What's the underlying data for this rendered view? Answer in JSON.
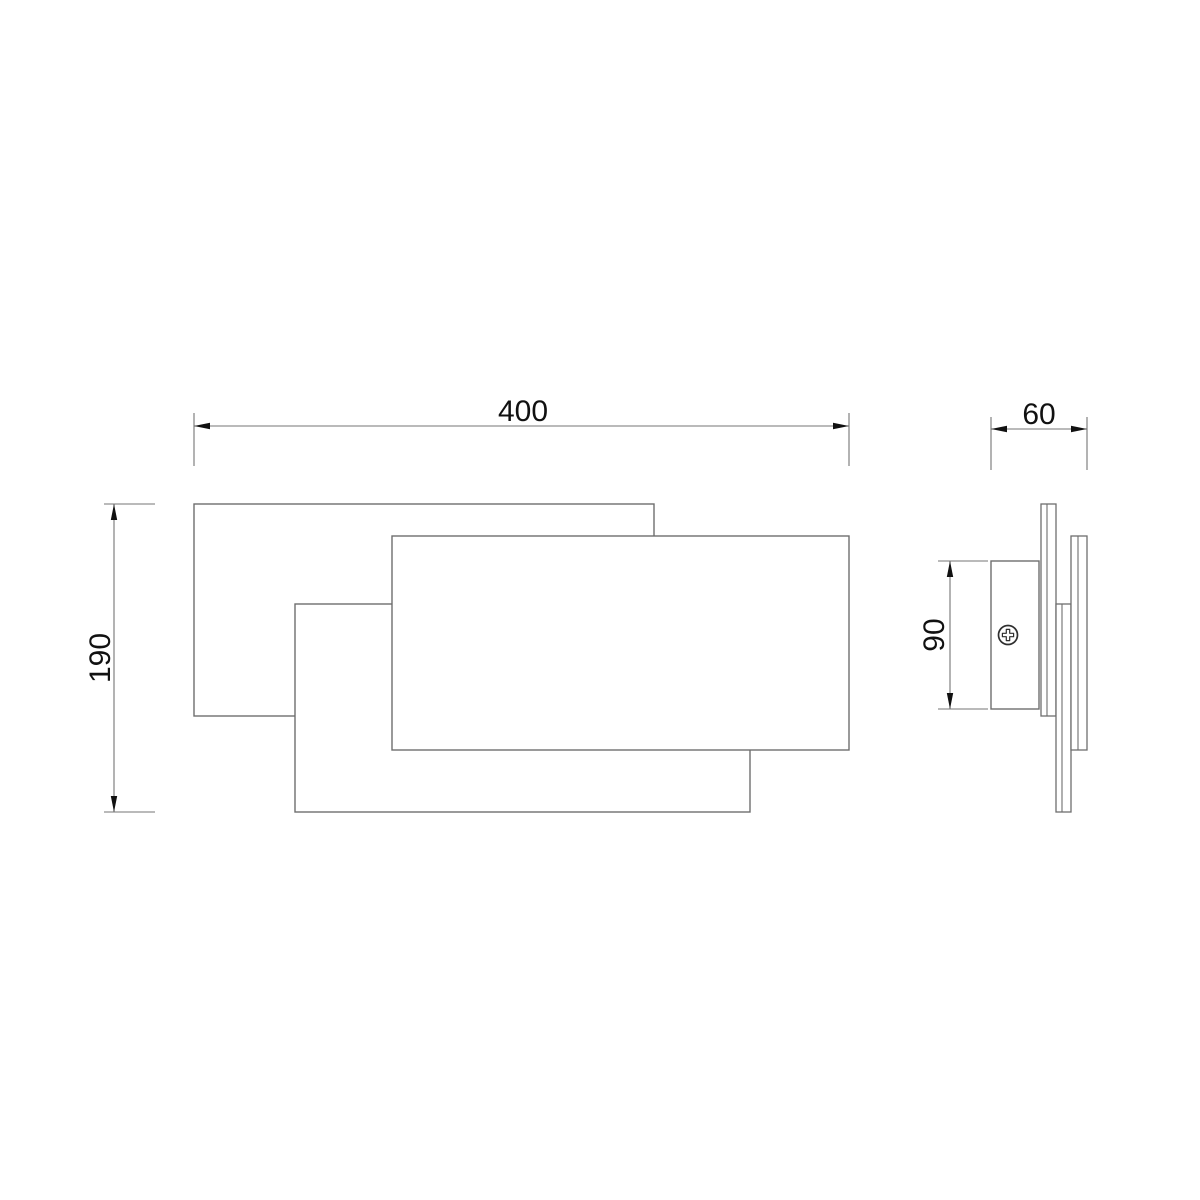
{
  "drawing": {
    "canvas": {
      "width": 1200,
      "height": 1200,
      "background": "#ffffff"
    },
    "colors": {
      "object_line": "#6e6e6e",
      "dimension_line": "#757575",
      "arrow": "#111111",
      "text": "#111111",
      "screw": "#2f2f2f",
      "fill": "#ffffff"
    },
    "font_size": 30,
    "arrow": {
      "length": 16,
      "half_width": 3.2
    },
    "front_view": {
      "name": "wall-lamp-front-view",
      "panels": [
        {
          "name": "back-panel",
          "x": 194,
          "y": 504,
          "width": 460,
          "height": 212
        },
        {
          "name": "middle-panel",
          "x": 295,
          "y": 604,
          "width": 455,
          "height": 208
        },
        {
          "name": "front-panel",
          "x": 392,
          "y": 536,
          "width": 457,
          "height": 214
        }
      ]
    },
    "side_view": {
      "name": "wall-lamp-side-view",
      "mount_bracket": {
        "x": 991,
        "y": 561,
        "width": 48,
        "height": 148
      },
      "screw": {
        "cx": 1008,
        "cy": 635,
        "outer_radius": 9.5,
        "cross_arm": 5.6,
        "cross_halfwidth": 1.7
      },
      "panels": [
        {
          "name": "back-panel-edge",
          "x": 1041,
          "y": 504,
          "width": 15,
          "height": 212,
          "inner_line_offset": 6
        },
        {
          "name": "middle-panel-edge",
          "x": 1056,
          "y": 604,
          "width": 15,
          "height": 208,
          "inner_line_offset": 6
        },
        {
          "name": "front-panel-edge",
          "x": 1071,
          "y": 536,
          "width": 16,
          "height": 214,
          "inner_line_offset": 7
        }
      ]
    },
    "dimensions": [
      {
        "name": "width-dimension",
        "label": "400",
        "orientation": "horizontal",
        "from": 194,
        "to": 849,
        "line_pos": 426,
        "ext_from": 413,
        "ext_to": 466,
        "text_x": 523,
        "text_y": 421
      },
      {
        "name": "depth-dimension",
        "label": "60",
        "orientation": "horizontal",
        "from": 991,
        "to": 1087,
        "line_pos": 429,
        "ext_from": 417,
        "ext_to": 470,
        "text_x": 1039,
        "text_y": 424
      },
      {
        "name": "height-dimension",
        "label": "190",
        "orientation": "vertical",
        "from": 504,
        "to": 812,
        "line_pos": 114,
        "ext_from": 104,
        "ext_to": 155,
        "text_x": 110,
        "text_y": 658
      },
      {
        "name": "bracket-height-dimension",
        "label": "90",
        "orientation": "vertical",
        "from": 561,
        "to": 709,
        "line_pos": 950,
        "ext_from": 938,
        "ext_to": 988,
        "text_x": 944,
        "text_y": 635
      }
    ]
  }
}
